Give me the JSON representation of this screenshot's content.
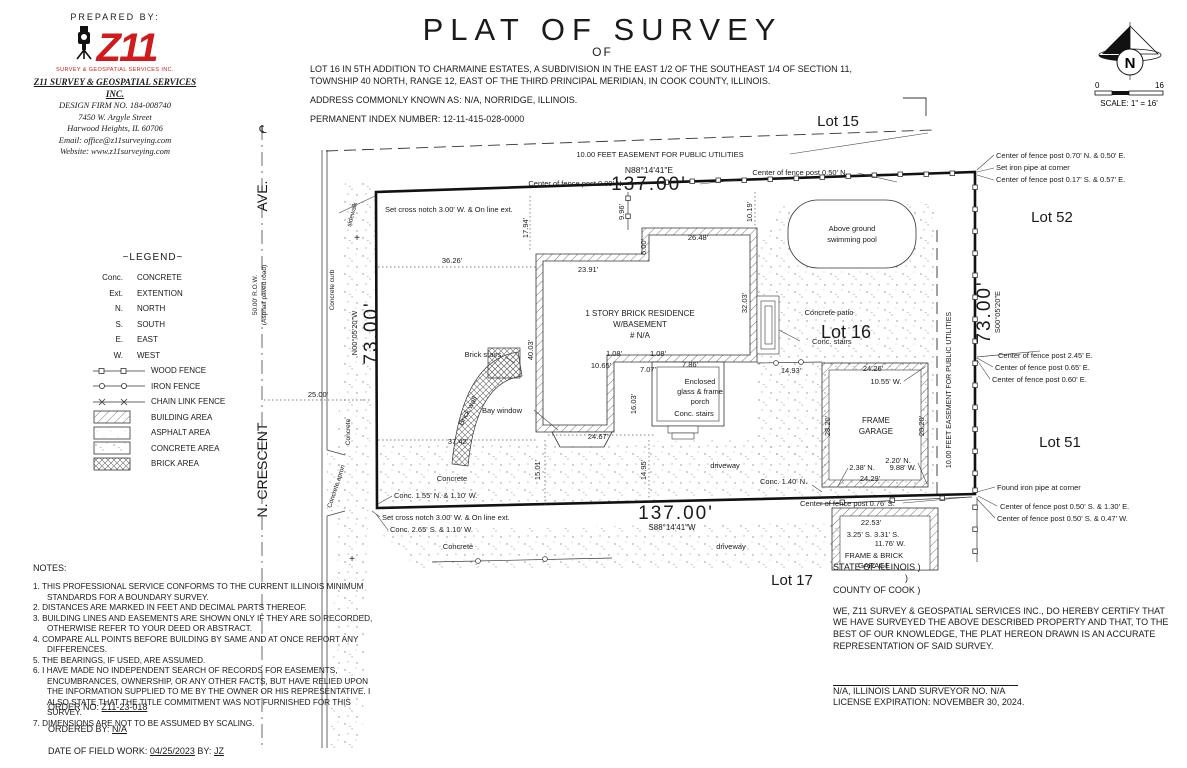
{
  "header": {
    "prepared_by": "PREPARED BY:",
    "logo_text": "Z11",
    "logo_tagline": "SURVEY & GEOSPATIAL SERVICES INC.",
    "firm_name": "Z11 SURVEY & GEOSPATIAL SERVICES INC.",
    "design_firm": "DESIGN FIRM NO. 184-008740",
    "street": "7450 W. Argyle Street",
    "city": "Harwood Heights, IL 60706",
    "email": "Email: office@z11surveying.com",
    "website": "Website: www.z11surveying.com"
  },
  "title": {
    "main": "PLAT OF SURVEY",
    "of": "OF",
    "legal": "LOT 16 IN 5TH ADDITION TO CHARMAINE ESTATES, A SUBDIVISION IN THE EAST 1/2 OF THE SOUTHEAST 1/4 OF SECTION 11, TOWNSHIP 40 NORTH, RANGE 12, EAST OF THE THIRD PRINCIPAL MERIDIAN, IN COOK COUNTY, ILLINOIS.",
    "address": "ADDRESS COMMONLY KNOWN AS: N/A, NORRIDGE, ILLINOIS.",
    "pin": "PERMANENT INDEX NUMBER: 12-11-415-028-0000"
  },
  "compass": {
    "n": "N",
    "scale_zero": "0",
    "scale_sixteen": "16",
    "scale_text": "SCALE: 1\" = 16'"
  },
  "legend": {
    "title": "~LEGEND~",
    "abbrevs": [
      {
        "abbr": "Conc.",
        "label": "CONCRETE"
      },
      {
        "abbr": "Ext.",
        "label": "EXTENTION"
      },
      {
        "abbr": "N.",
        "label": "NORTH"
      },
      {
        "abbr": "S.",
        "label": "SOUTH"
      },
      {
        "abbr": "E.",
        "label": "EAST"
      },
      {
        "abbr": "W.",
        "label": "WEST"
      }
    ],
    "lines": [
      {
        "label": "WOOD FENCE"
      },
      {
        "label": "IRON FENCE"
      },
      {
        "label": "CHAIN LINK FENCE"
      }
    ],
    "areas": [
      {
        "label": "BUILDING AREA"
      },
      {
        "label": "ASPHALT AREA"
      },
      {
        "label": "CONCRETE AREA"
      },
      {
        "label": "BRICK AREA"
      }
    ]
  },
  "notes": {
    "title": "NOTES:",
    "items": [
      "1. THIS PROFESSIONAL SERVICE CONFORMS TO THE CURRENT ILLINOIS MINIMUM STANDARDS FOR A BOUNDARY SURVEY.",
      "2. DISTANCES ARE MARKED IN FEET AND DECIMAL PARTS THEREOF.",
      "3. BUILDING LINES AND EASEMENTS ARE SHOWN ONLY IF THEY ARE SO RECORDED, OTHERWISE REFER TO YOUR DEED OR ABSTRACT.",
      "4. COMPARE ALL POINTS BEFORE BUILDING BY SAME AND AT ONCE REPORT ANY DIFFERENCES.",
      "5. THE BEARINGS, IF USED, ARE ASSUMED.",
      "6. I HAVE MADE NO INDEPENDENT SEARCH OF RECORDS FOR EASEMENTS, ENCUMBRANCES, OWNERSHIP, OR ANY OTHER FACTS, BUT HAVE RELIED UPON THE INFORMATION SUPPLIED TO ME BY THE OWNER OR HIS REPRESENTATIVE. I ALSO STATE THAT THE TITLE COMMITMENT WAS NOT FURNISHED FOR THIS SURVEY.",
      "7. DIMENSIONS ARE NOT TO BE ASSUMED BY SCALING."
    ]
  },
  "order": {
    "order_label": "ORDER NO:",
    "order_value": "Z11-23-018",
    "ordered_by_label": "ORDERED BY:",
    "ordered_by_value": "N/A",
    "fieldwork_label": "DATE OF FIELD WORK:",
    "fieldwork_date": "04/25/2023",
    "by_label": "BY:",
    "by_value": "JZ"
  },
  "certification": {
    "state": "STATE OF ILLINOIS )",
    "paren": ")",
    "county": "COUNTY OF COOK )",
    "body": "WE, Z11 SURVEY & GEOSPATIAL SERVICES INC., DO HEREBY CERTIFY THAT WE HAVE SURVEYED THE ABOVE DESCRIBED PROPERTY AND THAT, TO THE BEST OF OUR KNOWLEDGE, THE PLAT HEREON DRAWN IS AN ACCURATE REPRESENTATION OF SAID SURVEY.",
    "surveyor": "N/A, ILLINOIS LAND SURVEYOR NO. N/A",
    "license": "LICENSE EXPIRATION: NOVEMBER 30, 2024."
  },
  "plan": {
    "labels": [
      {
        "name": "lot-15-label",
        "text": "Lot 15",
        "x": 838,
        "y": 126,
        "size": 15,
        "anchor": "middle"
      },
      {
        "name": "lot-52-label",
        "text": "Lot 52",
        "x": 1052,
        "y": 222,
        "size": 15,
        "anchor": "middle"
      },
      {
        "name": "lot-51-label",
        "text": "Lot 51",
        "x": 1060,
        "y": 447,
        "size": 15,
        "anchor": "middle"
      },
      {
        "name": "lot-17-label",
        "text": "Lot 17",
        "x": 792,
        "y": 585,
        "size": 15,
        "anchor": "middle"
      },
      {
        "name": "lot-16-label",
        "text": "Lot 16",
        "x": 846,
        "y": 338,
        "size": 18,
        "anchor": "middle"
      },
      {
        "name": "easement-north-label",
        "text": "10.00 FEET EASEMENT FOR PUBLIC UTILITIES",
        "x": 660,
        "y": 157,
        "size": 7.5,
        "anchor": "middle"
      },
      {
        "name": "bearing-north",
        "text": "N88°14'41\"E",
        "x": 649,
        "y": 173,
        "size": 8.5,
        "anchor": "middle"
      },
      {
        "name": "dim-north-137",
        "text": "137.00'",
        "x": 649,
        "y": 190,
        "size": 19,
        "anchor": "middle",
        "ls": 2
      },
      {
        "name": "fence-post-009n",
        "text": "Center of fence post 0.09' N.",
        "x": 576,
        "y": 186,
        "size": 7.5,
        "anchor": "middle"
      },
      {
        "name": "fence-post-050n",
        "text": "Center of fence post 0.50' N.",
        "x": 800,
        "y": 175,
        "size": 7.5,
        "anchor": "middle"
      },
      {
        "name": "cross-notch-north",
        "text": "Set cross notch 3.00' W. & On line ext.",
        "x": 385,
        "y": 212,
        "size": 7.5
      },
      {
        "name": "fence-post-070n-050e",
        "text": "Center of fence post 0.70' N. & 0.50' E.",
        "x": 996,
        "y": 158,
        "size": 7.5
      },
      {
        "name": "set-iron-pipe",
        "text": "Set iron pipe at corner",
        "x": 996,
        "y": 170,
        "size": 7.5
      },
      {
        "name": "fence-post-017s-057e",
        "text": "Center of fence post 0.17' S. & 0.57' E.",
        "x": 996,
        "y": 182,
        "size": 7.5
      },
      {
        "name": "centerline-symbol",
        "text": "℄",
        "x": 263,
        "y": 133,
        "size": 11,
        "anchor": "middle"
      },
      {
        "name": "street-ave",
        "text": "AVE.",
        "x": 267,
        "y": 196,
        "size": 14,
        "rot": -90,
        "anchor": "middle"
      },
      {
        "name": "street-n-crescent",
        "text": "N. CRESCENT",
        "x": 267,
        "y": 470,
        "size": 14,
        "rot": -90,
        "anchor": "middle"
      },
      {
        "name": "row-50",
        "text": "50.00' R.O.W.",
        "x": 257,
        "y": 295,
        "size": 6.5,
        "rot": -90,
        "anchor": "middle"
      },
      {
        "name": "asphalt-road",
        "text": "(Asphalt paved road)",
        "x": 266,
        "y": 295,
        "size": 6.5,
        "rot": -90,
        "anchor": "middle"
      },
      {
        "name": "concrete-curb-label",
        "text": "Concrete curb",
        "x": 334,
        "y": 290,
        "size": 6.5,
        "rot": -90,
        "anchor": "middle"
      },
      {
        "name": "sidewalk-label",
        "text": "sidewalk",
        "x": 354,
        "y": 215,
        "size": 6.5,
        "rot": -75,
        "anchor": "middle"
      },
      {
        "name": "dim-25",
        "text": "25.00'",
        "x": 318,
        "y": 397,
        "size": 7.5,
        "anchor": "middle"
      },
      {
        "name": "bearing-west",
        "text": "N00°05'20\"W",
        "x": 357,
        "y": 333,
        "size": 7.5,
        "rot": -90,
        "anchor": "middle"
      },
      {
        "name": "dim-west-73",
        "text": "73.00'",
        "x": 377,
        "y": 333,
        "size": 19,
        "rot": -90,
        "anchor": "middle",
        "ls": 2
      },
      {
        "name": "dim-east-73",
        "text": "73.00'",
        "x": 990,
        "y": 312,
        "size": 19,
        "rot": -90,
        "anchor": "middle",
        "ls": 2
      },
      {
        "name": "bearing-east",
        "text": "S00°05'20\"E",
        "x": 1000,
        "y": 312,
        "size": 7.5,
        "rot": -90,
        "anchor": "middle"
      },
      {
        "name": "easement-east-label",
        "text": "10.00 FEET EASEMENT FOR PUBLIC UTILITIES",
        "x": 951,
        "y": 390,
        "size": 7,
        "rot": -90,
        "anchor": "middle"
      },
      {
        "name": "fence-post-245e",
        "text": "Center of fence post 2.45' E.",
        "x": 998,
        "y": 358,
        "size": 7.5
      },
      {
        "name": "fence-post-065e",
        "text": "Center of fence post 0.65' E.",
        "x": 995,
        "y": 370,
        "size": 7.5
      },
      {
        "name": "fence-post-060e",
        "text": "Center of fence post 0.60' E.",
        "x": 992,
        "y": 382,
        "size": 7.5
      },
      {
        "name": "found-iron-pipe",
        "text": "Found iron pipe at corner",
        "x": 997,
        "y": 490,
        "size": 7.5
      },
      {
        "name": "fence-post-050s-130e",
        "text": "Center of fence post 0.50' S. & 1.30' E.",
        "x": 1000,
        "y": 509,
        "size": 7.5
      },
      {
        "name": "fence-post-050s-047w",
        "text": "Center of fence post 0.50' S. & 0.47' W.",
        "x": 997,
        "y": 521,
        "size": 7.5
      },
      {
        "name": "dim-3626",
        "text": "36.26'",
        "x": 452,
        "y": 263,
        "size": 7.5,
        "anchor": "middle"
      },
      {
        "name": "dim-2391",
        "text": "23.91'",
        "x": 588,
        "y": 272,
        "size": 7.5,
        "anchor": "middle"
      },
      {
        "name": "dim-1794",
        "text": "17.94'",
        "x": 528,
        "y": 228,
        "size": 7.5,
        "rot": -90,
        "anchor": "middle"
      },
      {
        "name": "dim-996",
        "text": "9.96'",
        "x": 624,
        "y": 212,
        "size": 7.5,
        "rot": -90,
        "anchor": "middle"
      },
      {
        "name": "dim-2648",
        "text": "26.48'",
        "x": 698,
        "y": 240,
        "size": 7.5,
        "anchor": "middle"
      },
      {
        "name": "dim-600",
        "text": "6.00'",
        "x": 646,
        "y": 247,
        "size": 7.5,
        "rot": -90,
        "anchor": "middle"
      },
      {
        "name": "dim-1019",
        "text": "10.19'",
        "x": 752,
        "y": 212,
        "size": 7.5,
        "rot": -90,
        "anchor": "middle"
      },
      {
        "name": "pool-label-1",
        "text": "Above ground",
        "x": 852,
        "y": 231,
        "size": 7.5,
        "anchor": "middle"
      },
      {
        "name": "pool-label-2",
        "text": "swimming pool",
        "x": 852,
        "y": 242,
        "size": 7.5,
        "anchor": "middle"
      },
      {
        "name": "residence-label-1",
        "text": "1 STORY BRICK RESIDENCE",
        "x": 640,
        "y": 316,
        "size": 8,
        "anchor": "middle"
      },
      {
        "name": "residence-label-2",
        "text": "W/BASEMENT",
        "x": 640,
        "y": 327,
        "size": 8,
        "anchor": "middle"
      },
      {
        "name": "residence-label-3",
        "text": "# N/A",
        "x": 640,
        "y": 338,
        "size": 8,
        "anchor": "middle"
      },
      {
        "name": "dim-3203",
        "text": "32.03'",
        "x": 747,
        "y": 303,
        "size": 7.5,
        "rot": -90,
        "anchor": "middle"
      },
      {
        "name": "dim-4003",
        "text": "40.03'",
        "x": 533,
        "y": 350,
        "size": 7.5,
        "rot": -90,
        "anchor": "middle"
      },
      {
        "name": "brick-stairs-label",
        "text": "Brick stairs",
        "x": 483,
        "y": 357,
        "size": 7.5,
        "anchor": "middle"
      },
      {
        "name": "brick-wall-label",
        "text": "Brick wall",
        "x": 470,
        "y": 412,
        "size": 7.5,
        "rot": -62,
        "anchor": "middle"
      },
      {
        "name": "bay-window-label",
        "text": "Bay window",
        "x": 502,
        "y": 413,
        "size": 7.5,
        "anchor": "middle"
      },
      {
        "name": "dim-3742",
        "text": "37.42'",
        "x": 458,
        "y": 444,
        "size": 7.5,
        "anchor": "middle"
      },
      {
        "name": "dim-2467",
        "text": "24.67'",
        "x": 598,
        "y": 439,
        "size": 7.5,
        "anchor": "middle"
      },
      {
        "name": "dim-108a",
        "text": "1.08'",
        "x": 614,
        "y": 356,
        "size": 7.5,
        "anchor": "middle"
      },
      {
        "name": "dim-108b",
        "text": "1.08'",
        "x": 658,
        "y": 356,
        "size": 7.5,
        "anchor": "middle"
      },
      {
        "name": "dim-1065",
        "text": "10.65'",
        "x": 601,
        "y": 368,
        "size": 7.5,
        "anchor": "middle"
      },
      {
        "name": "dim-707",
        "text": "7.07'",
        "x": 648,
        "y": 372,
        "size": 7.5,
        "anchor": "middle"
      },
      {
        "name": "dim-786",
        "text": "7.86'",
        "x": 690,
        "y": 367,
        "size": 7.5,
        "anchor": "middle"
      },
      {
        "name": "dim-1493",
        "text": "14.93'",
        "x": 791,
        "y": 373,
        "size": 7.5,
        "anchor": "middle"
      },
      {
        "name": "porch-label-1",
        "text": "Enclosed",
        "x": 700,
        "y": 384,
        "size": 7.5,
        "anchor": "middle"
      },
      {
        "name": "porch-label-2",
        "text": "glass & frame",
        "x": 700,
        "y": 394,
        "size": 7.5,
        "anchor": "middle"
      },
      {
        "name": "porch-label-3",
        "text": "porch",
        "x": 700,
        "y": 404,
        "size": 7.5,
        "anchor": "middle"
      },
      {
        "name": "dim-1603",
        "text": "16.03'",
        "x": 636,
        "y": 404,
        "size": 7.5,
        "rot": -90,
        "anchor": "middle"
      },
      {
        "name": "porch-stairs-label",
        "text": "Conc. stairs",
        "x": 694,
        "y": 416,
        "size": 7.5,
        "anchor": "middle"
      },
      {
        "name": "patio-stairs-label",
        "text": "Conc. stairs",
        "x": 812,
        "y": 344,
        "size": 7.5
      },
      {
        "name": "patio-label",
        "text": "Concrete patio",
        "x": 829,
        "y": 315,
        "size": 7.5,
        "anchor": "middle"
      },
      {
        "name": "dim-2426",
        "text": "24.26'",
        "x": 873,
        "y": 371,
        "size": 7.5,
        "anchor": "middle"
      },
      {
        "name": "dim-1055w",
        "text": "10.55' W.",
        "x": 886,
        "y": 384,
        "size": 7.5,
        "anchor": "middle"
      },
      {
        "name": "garage-label-1",
        "text": "FRAME",
        "x": 876,
        "y": 423,
        "size": 8,
        "anchor": "middle"
      },
      {
        "name": "garage-label-2",
        "text": "GARAGE",
        "x": 876,
        "y": 434,
        "size": 8,
        "anchor": "middle"
      },
      {
        "name": "dim-2820-w",
        "text": "28.20'",
        "x": 830,
        "y": 426,
        "size": 7.5,
        "rot": -90,
        "anchor": "middle"
      },
      {
        "name": "dim-2820-e",
        "text": "28.20'",
        "x": 924,
        "y": 426,
        "size": 7.5,
        "rot": -90,
        "anchor": "middle"
      },
      {
        "name": "dim-220n",
        "text": "2.20' N.",
        "x": 898,
        "y": 463,
        "size": 7.5,
        "anchor": "middle"
      },
      {
        "name": "dim-238n",
        "text": "2.38' N.",
        "x": 862,
        "y": 470,
        "size": 7.5,
        "anchor": "middle"
      },
      {
        "name": "dim-988w",
        "text": "9.88' W.",
        "x": 903,
        "y": 470,
        "size": 7.5,
        "anchor": "middle"
      },
      {
        "name": "dim-2429",
        "text": "24.29'",
        "x": 870,
        "y": 481,
        "size": 7.5,
        "anchor": "middle"
      },
      {
        "name": "dim-1495",
        "text": "14.95'",
        "x": 646,
        "y": 470,
        "size": 7.5,
        "rot": -90,
        "anchor": "middle"
      },
      {
        "name": "dim-1501",
        "text": "15.01'",
        "x": 540,
        "y": 470,
        "size": 7.5,
        "rot": -90,
        "anchor": "middle"
      },
      {
        "name": "driveway-label-1",
        "text": "driveway",
        "x": 725,
        "y": 468,
        "size": 7.5,
        "anchor": "middle"
      },
      {
        "name": "conc-140n",
        "text": "Conc. 1.40' N.",
        "x": 760,
        "y": 484,
        "size": 7.5
      },
      {
        "name": "concrete-sw-label",
        "text": "Concrete",
        "x": 452,
        "y": 481,
        "size": 7.5,
        "anchor": "middle"
      },
      {
        "name": "conc-155n-110w",
        "text": "Conc. 1.55' N. & 1.10' W.",
        "x": 394,
        "y": 498,
        "size": 7.5
      },
      {
        "name": "dim-south-137",
        "text": "137.00'",
        "x": 676,
        "y": 519,
        "size": 19,
        "anchor": "middle",
        "ls": 2
      },
      {
        "name": "bearing-south",
        "text": "S88°14'41\"W",
        "x": 672,
        "y": 530,
        "size": 8,
        "anchor": "middle"
      },
      {
        "name": "fence-post-076s",
        "text": "Center of fence post 0.76' S.",
        "x": 800,
        "y": 506,
        "size": 7.5
      },
      {
        "name": "cross-notch-south",
        "text": "Set cross notch 3.00' W. & On line ext.",
        "x": 382,
        "y": 520,
        "size": 7.5
      },
      {
        "name": "conc-265s-110w",
        "text": "Conc. 2.65' S. & 1.10' W.",
        "x": 390,
        "y": 532,
        "size": 7.5
      },
      {
        "name": "concrete-s-label",
        "text": "Concrete",
        "x": 458,
        "y": 549,
        "size": 7.5,
        "anchor": "middle"
      },
      {
        "name": "driveway-label-2",
        "text": "driveway",
        "x": 731,
        "y": 549,
        "size": 7.5,
        "anchor": "middle"
      },
      {
        "name": "dim-2253",
        "text": "22.53'",
        "x": 871,
        "y": 525,
        "size": 7.5,
        "anchor": "middle"
      },
      {
        "name": "dim-325s-331s",
        "text": "3.25' S.  3.31' S.",
        "x": 873,
        "y": 537,
        "size": 7.5,
        "anchor": "middle"
      },
      {
        "name": "dim-1176w",
        "text": "11.76' W.",
        "x": 890,
        "y": 546,
        "size": 7.5,
        "anchor": "middle"
      },
      {
        "name": "garage2-label-1",
        "text": "FRAME & BRICK",
        "x": 874,
        "y": 558,
        "size": 7.5,
        "anchor": "middle"
      },
      {
        "name": "garage2-label-2",
        "text": "GARAGE",
        "x": 874,
        "y": 568,
        "size": 7.5,
        "anchor": "middle"
      },
      {
        "name": "concrete-apron-label",
        "text": "Concrete apron",
        "x": 338,
        "y": 487,
        "size": 6.5,
        "rot": -72,
        "anchor": "middle"
      },
      {
        "name": "concrete-w-label",
        "text": "Concrete",
        "x": 350,
        "y": 432,
        "size": 6.5,
        "rot": -90,
        "anchor": "middle"
      },
      {
        "name": "plus-mark-1",
        "text": "+",
        "x": 357,
        "y": 241,
        "size": 10,
        "anchor": "middle"
      },
      {
        "name": "plus-mark-2",
        "text": "+",
        "x": 352,
        "y": 562,
        "size": 10,
        "anchor": "middle"
      }
    ]
  }
}
